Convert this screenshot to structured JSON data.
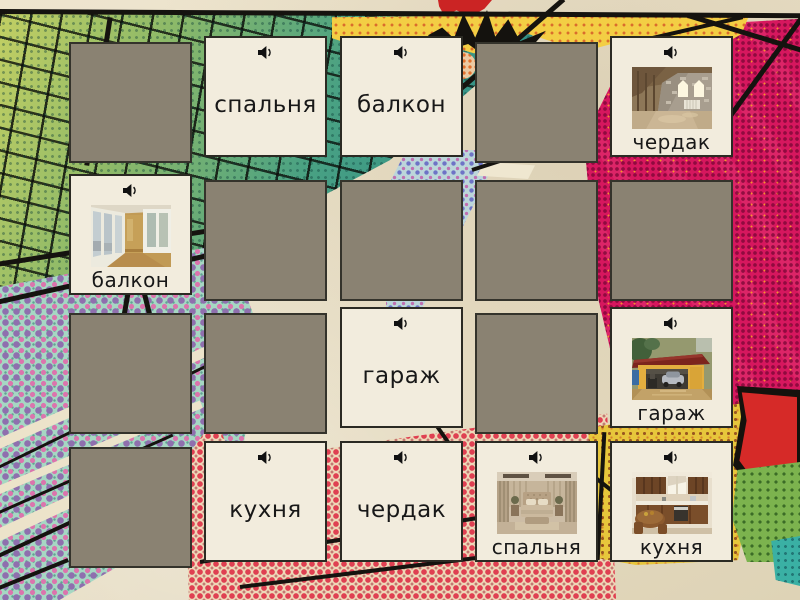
{
  "game": {
    "kind": "memory-match-grid",
    "language": "ru",
    "cards": [
      {
        "row": 0,
        "col": 0,
        "state": "hidden"
      },
      {
        "row": 0,
        "col": 1,
        "state": "word",
        "label": "спальня"
      },
      {
        "row": 0,
        "col": 2,
        "state": "word",
        "label": "балкон"
      },
      {
        "row": 0,
        "col": 3,
        "state": "hidden"
      },
      {
        "row": 0,
        "col": 4,
        "state": "image",
        "label": "чердак",
        "image": "attic-photo"
      },
      {
        "row": 1,
        "col": 0,
        "state": "image",
        "label": "балкон",
        "image": "balcony-photo"
      },
      {
        "row": 1,
        "col": 1,
        "state": "hidden"
      },
      {
        "row": 1,
        "col": 2,
        "state": "hidden"
      },
      {
        "row": 1,
        "col": 3,
        "state": "hidden"
      },
      {
        "row": 1,
        "col": 4,
        "state": "hidden"
      },
      {
        "row": 2,
        "col": 0,
        "state": "hidden"
      },
      {
        "row": 2,
        "col": 1,
        "state": "hidden"
      },
      {
        "row": 2,
        "col": 2,
        "state": "word",
        "label": "гараж"
      },
      {
        "row": 2,
        "col": 3,
        "state": "hidden"
      },
      {
        "row": 2,
        "col": 4,
        "state": "image",
        "label": "гараж",
        "image": "garage-photo"
      },
      {
        "row": 3,
        "col": 0,
        "state": "hidden"
      },
      {
        "row": 3,
        "col": 1,
        "state": "word",
        "label": "кухня"
      },
      {
        "row": 3,
        "col": 2,
        "state": "word",
        "label": "чердак"
      },
      {
        "row": 3,
        "col": 3,
        "state": "image",
        "label": "спальня",
        "image": "bedroom-photo"
      },
      {
        "row": 3,
        "col": 4,
        "state": "image",
        "label": "кухня",
        "image": "kitchen-photo"
      }
    ],
    "icons": {
      "speaker": "speaker-icon"
    }
  },
  "colors": {
    "card_face": "#f2ecdd",
    "card_back": "#8a8272",
    "card_border": "#2b2a23",
    "text": "#181818",
    "paper": "#e7ddc3",
    "teal": "#2f8f87",
    "crimson": "#d6175e",
    "yellow": "#f3ce44"
  }
}
